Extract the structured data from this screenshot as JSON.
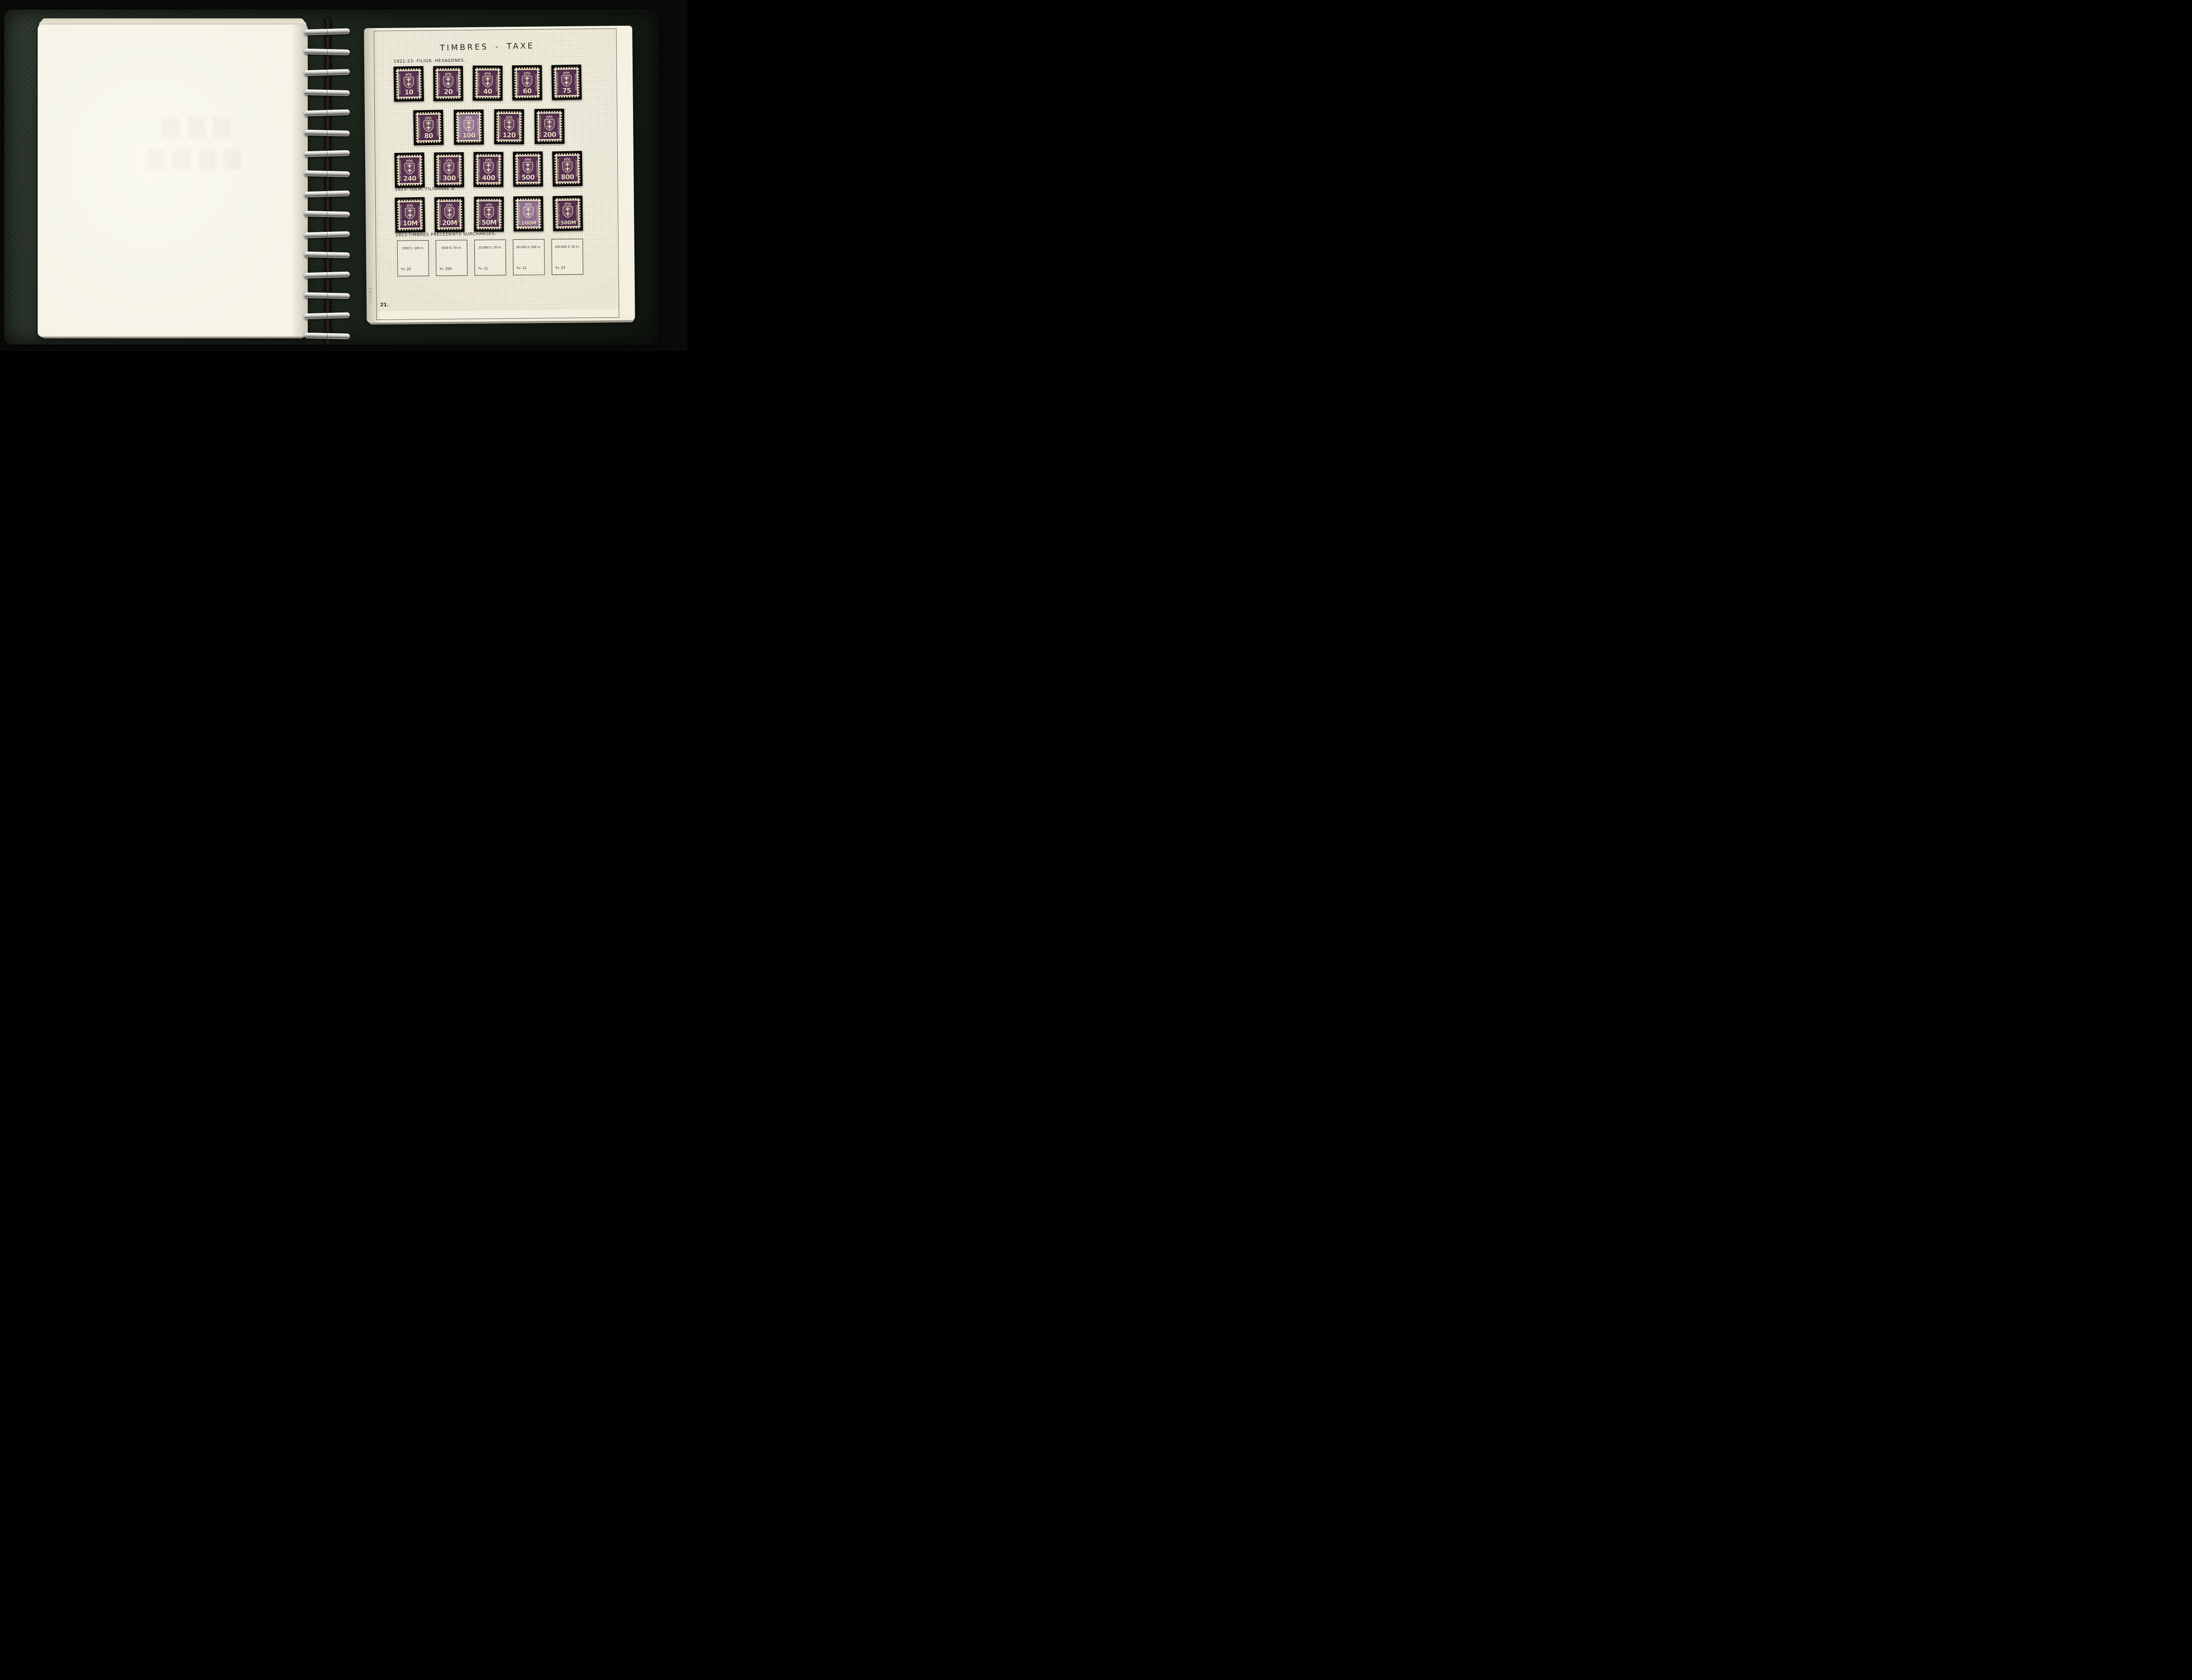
{
  "binder": {
    "ring_count": 16,
    "cover_color": "#222b21",
    "background_color": "#0a0908",
    "ring_color": "#c9c7c2"
  },
  "left_page": {
    "content": ""
  },
  "page": {
    "title": "TIMBRES - TAXE",
    "page_number": "21.",
    "brand": "EDIFIL",
    "sections": [
      {
        "heading": "1921-23- FILIGR. HEXAGONES.",
        "rows": [
          {
            "values": [
              "10",
              "20",
              "40",
              "60",
              "75"
            ],
            "pale": []
          },
          {
            "values": [
              "80",
              "100",
              "120",
              "200"
            ],
            "pale": [
              1
            ]
          },
          {
            "values": [
              "240",
              "300",
              "400",
              "500",
              "800"
            ],
            "pale": []
          }
        ]
      },
      {
        "heading": "1923- IDEM. FILIGRANE B.",
        "rows": [
          {
            "values": [
              "10M",
              "20M",
              "50M",
              "100M",
              "500M"
            ],
            "pale": [
              3
            ]
          }
        ]
      },
      {
        "heading": "1923-TIMBRES PRÉCÉDENTS SURCHARGÉS.",
        "boxes": [
          {
            "label": "1000 S. 100 m.",
            "catalog": "Yv. 20"
          },
          {
            "label": "5000 S. 50 m.",
            "catalog": "Yv. 20A"
          },
          {
            "label": "10.000 S. 20 m.",
            "catalog": "Yv. 21"
          },
          {
            "label": "50.000 S. 500 m.",
            "catalog": "Yv. 22"
          },
          {
            "label": "100.000 S. 20 m.",
            "catalog": "Yv. 23"
          }
        ]
      }
    ]
  },
  "stamp": {
    "left_text": "VOM EMPFÄNGER",
    "right_text": "EINZUZIEHEN",
    "colors": {
      "deep_purple": "#56314f",
      "pale_purple": "#8f7090",
      "paper": "#eadfc2",
      "mount": "#0a0908"
    }
  }
}
